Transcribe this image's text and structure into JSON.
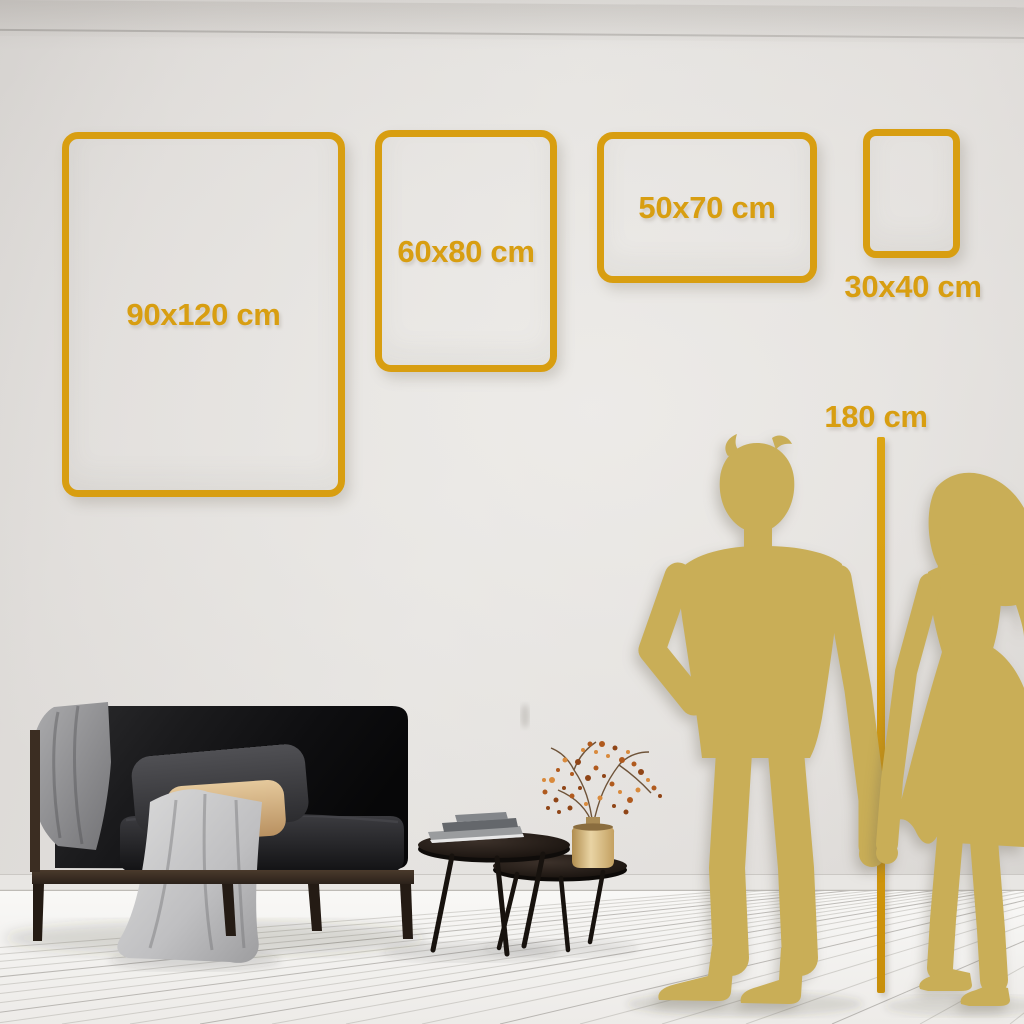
{
  "sizes": [
    {
      "label": "90x120 cm"
    },
    {
      "label": "60x80 cm"
    },
    {
      "label": "50x70 cm"
    },
    {
      "label": "30x40 cm"
    }
  ],
  "height_reference": {
    "label": "180 cm"
  },
  "colors": {
    "accent_gold": "#D89E11",
    "silhouette_gold": "#C9AE57",
    "wall": "#DFDCD9",
    "floor": "#F5F4F2"
  },
  "scene": {
    "items": [
      "sofa-with-blanket-and-pillows",
      "nesting-coffee-tables",
      "books-stack",
      "gold-vase-with-dried-branches",
      "man-silhouette",
      "woman-silhouette",
      "height-ruler-line",
      "plank-floor"
    ]
  }
}
